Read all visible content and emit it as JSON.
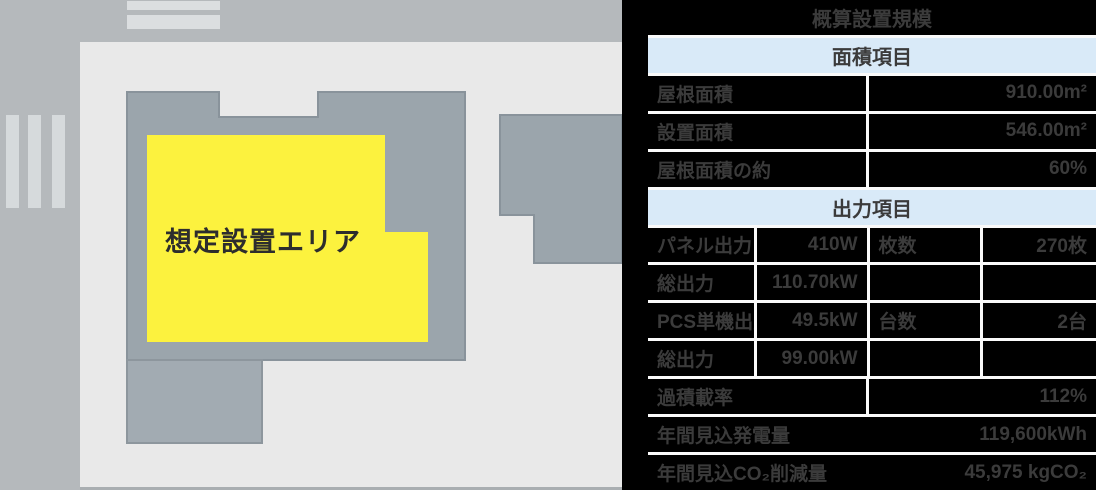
{
  "map": {
    "installation_area_label": "想定設置エリア",
    "colors": {
      "road_gray": "#b5b9bc",
      "site_light_gray": "#e9e9e9",
      "building_fill": "#9ba5ac",
      "building_border": "#89939b",
      "annex_fill": "#a2abb2",
      "highlight_yellow": "#fcf23e",
      "stripe_light": "#d6dadc"
    }
  },
  "table": {
    "title": "概算設置規模",
    "section_area": "面積項目",
    "section_output": "出力項目",
    "colors": {
      "cell_background": "#000000",
      "text": "#3b3b3b",
      "section_background": "#d9eaf8",
      "border": "#fafafa"
    },
    "rows": {
      "roof_area": {
        "label": "屋根面積",
        "value": "910.00m²"
      },
      "install_area": {
        "label": "設置面積",
        "value": "546.00m²"
      },
      "roof_ratio": {
        "label": "屋根面積の約",
        "value": "60%"
      },
      "panel_output": {
        "label": "パネル出力",
        "value": "410W",
        "label2": "枚数",
        "value2": "270枚"
      },
      "total_output_1": {
        "label": "総出力",
        "value": "110.70kW",
        "label2": "",
        "value2": ""
      },
      "pcs_output": {
        "label": "PCS単機出力",
        "value": "49.5kW",
        "label2": "台数",
        "value2": "2台"
      },
      "total_output_2": {
        "label": "総出力",
        "value": "99.00kW",
        "label2": "",
        "value2": ""
      },
      "overload_ratio": {
        "label": "過積載率",
        "value": "112%"
      },
      "annual_energy": {
        "label": "年間見込発電量",
        "value": "119,600kWh"
      },
      "annual_co2": {
        "label": "年間見込CO₂削減量",
        "value": "45,975 kgCO₂"
      }
    }
  }
}
